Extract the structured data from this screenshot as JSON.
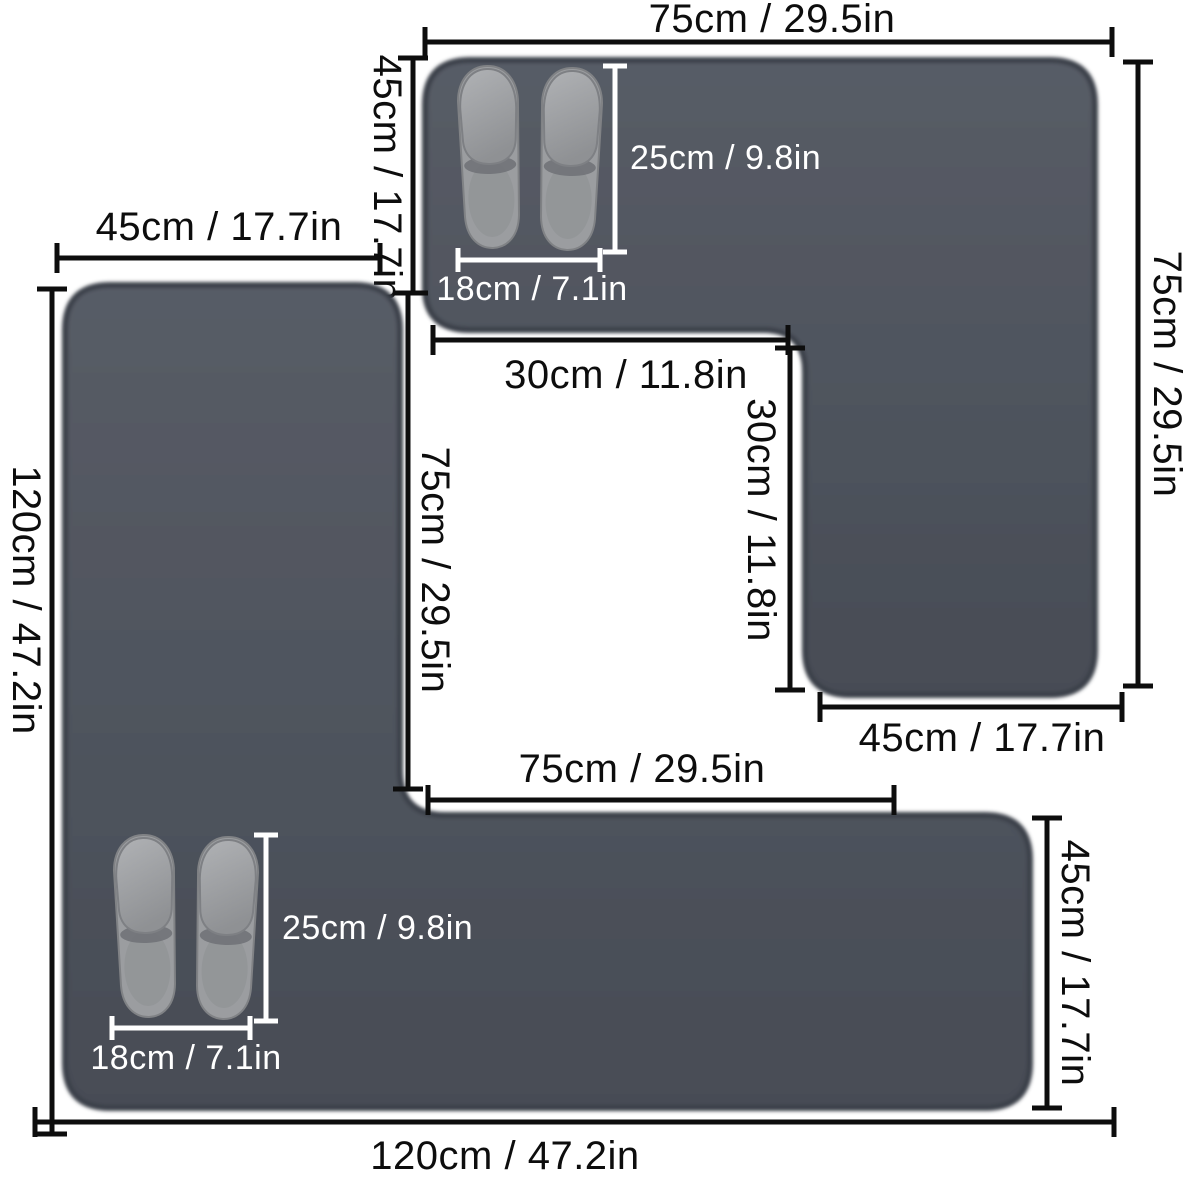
{
  "colors": {
    "background": "#ffffff",
    "mat_fill": "#4e545e",
    "mat_fill_light": "#565b66",
    "mat_edge": "#3b3f48",
    "dimension_line": "#0d0d0d",
    "slipper_label_text": "#ffffff",
    "slipper_body": "#9b9da0"
  },
  "icons": {
    "slippers": "pair of gray hotel slippers shown for scale"
  },
  "top_mat": {
    "top_width": "75cm / 29.5in",
    "left_height": "45cm / 17.7in",
    "right_height": "75cm / 29.5in",
    "inner_width": "30cm / 11.8in",
    "inner_height": "30cm / 11.8in",
    "bottom_width": "45cm / 17.7in",
    "slipper_length": "25cm / 9.8in",
    "slipper_width": "18cm / 7.1in"
  },
  "bottom_mat": {
    "top_width": "45cm / 17.7in",
    "left_height": "120cm / 47.2in",
    "inner_height": "75cm / 29.5in",
    "inner_width": "75cm / 29.5in",
    "right_height": "45cm / 17.7in",
    "bottom_width": "120cm / 47.2in",
    "slipper_length": "25cm / 9.8in",
    "slipper_width": "18cm / 7.1in"
  }
}
